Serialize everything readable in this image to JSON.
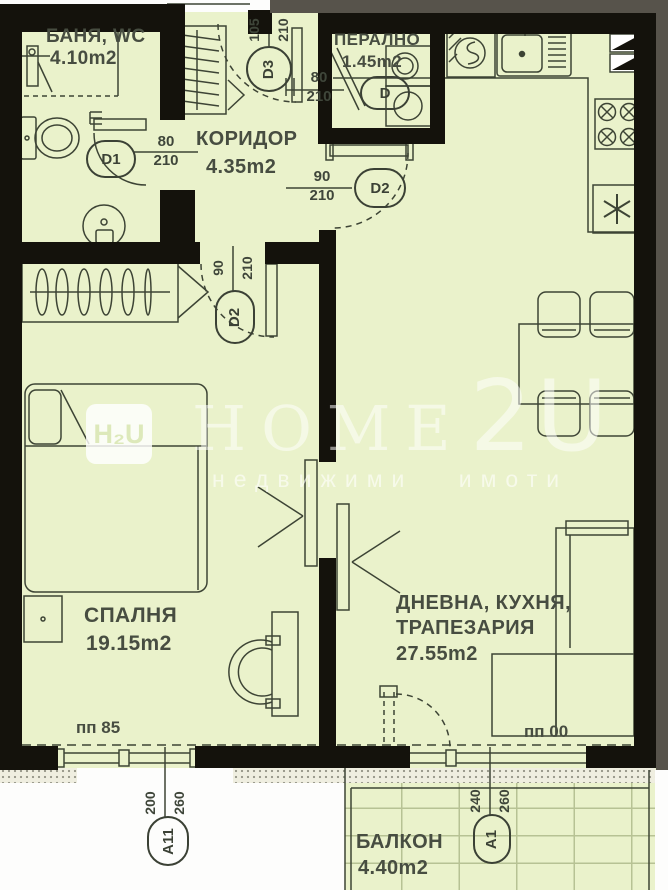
{
  "plan": {
    "watermark": {
      "logo": "H₂U",
      "brand_main": "HOME",
      "brand_suffix": "2U",
      "tagline": "недвижими имоти"
    },
    "rooms": {
      "bathroom": {
        "name": "БАНЯ, WC",
        "area": "4.10m2"
      },
      "laundry": {
        "name": "ПЕРАЛНО",
        "area": "1.45m2"
      },
      "corridor": {
        "name": "КОРИДОР",
        "area": "4.35m2"
      },
      "bedroom": {
        "name": "СПАЛНЯ",
        "area": "19.15m2"
      },
      "living": {
        "name_line1": "ДНЕВНА, КУХНЯ,",
        "name_line2": "ТРАПЕЗАРИЯ",
        "area": "27.55m2"
      },
      "balcony": {
        "name": "БАЛКОН",
        "area": "4.40m2"
      }
    },
    "doors": {
      "d1": {
        "label": "D1",
        "width": "80",
        "height": "210"
      },
      "d2": {
        "label": "D2",
        "width": "90",
        "height": "210"
      },
      "d3": {
        "label": "D3",
        "width": "105",
        "height": "210"
      },
      "d": {
        "label": "D",
        "width": "80",
        "height": "210"
      }
    },
    "windows": {
      "a11": {
        "label": "A11",
        "width": "200",
        "height": "260"
      },
      "a1": {
        "label": "A1",
        "width": "240",
        "height": "260"
      }
    },
    "parapets": {
      "bedroom": "пп 85",
      "living": "пп 00"
    },
    "colors": {
      "floor": "#eaf2cb",
      "wall": "#14120c",
      "line": "#3d4435",
      "margin": "#57534b"
    }
  }
}
